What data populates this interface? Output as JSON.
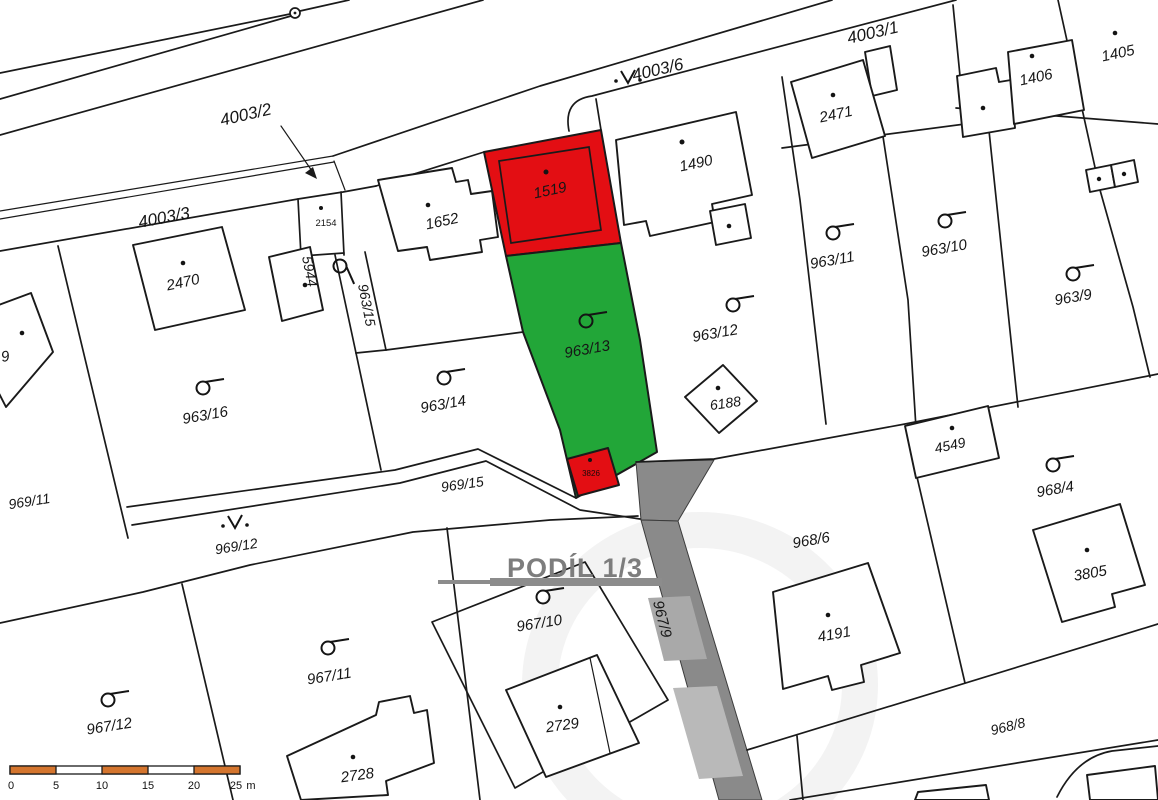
{
  "map": {
    "type": "cadastral-map",
    "overlay": {
      "share_text": "PODÍL 1/3"
    },
    "colors": {
      "highlight_red": "#e30e13",
      "highlight_green": "#22a638",
      "road_gray": "#8a8a8a",
      "overlay_gray": "#7d7d7d",
      "scalebar_orange": "#d4752e",
      "line_black": "#1a1a1a",
      "background": "#ffffff"
    },
    "labels": {
      "r4003_2": "4003/2",
      "r4003_3": "4003/3",
      "r4003_6": "4003/6",
      "r4003_1": "4003/1",
      "b2470": "2470",
      "b2154": "2154",
      "b5944": "5944",
      "p963_15": "963/15",
      "b1652": "1652",
      "b1519": "1519",
      "b1490": "1490",
      "b2471": "2471",
      "b1406": "1406",
      "b1405": "1405",
      "p963_16": "963/16",
      "p963_14": "963/14",
      "p963_13": "963/13",
      "p963_12": "963/12",
      "p963_11": "963/11",
      "p963_10": "963/10",
      "p963_9": "963/9",
      "b6188": "6188",
      "b3826": "3826",
      "r969_15": "969/15",
      "r969_12": "969/12",
      "r969_11": "969/11",
      "p967_12": "967/12",
      "p967_11": "967/11",
      "p967_10": "967/10",
      "b2728": "2728",
      "b2729": "2729",
      "r967_9": "967/9",
      "p968_6": "968/6",
      "b4191": "4191",
      "p968_4": "968/4",
      "b4549": "4549",
      "b3805": "3805",
      "r968_8": "968/8",
      "partial_9": "9"
    },
    "scale_bar": {
      "ticks": [
        "0",
        "5",
        "10",
        "15",
        "20",
        "25"
      ],
      "unit": "m"
    },
    "icons": [
      "survey-point-circle",
      "culvert-v-symbol",
      "landuse-flag-symbol",
      "arrow-pointer"
    ]
  }
}
